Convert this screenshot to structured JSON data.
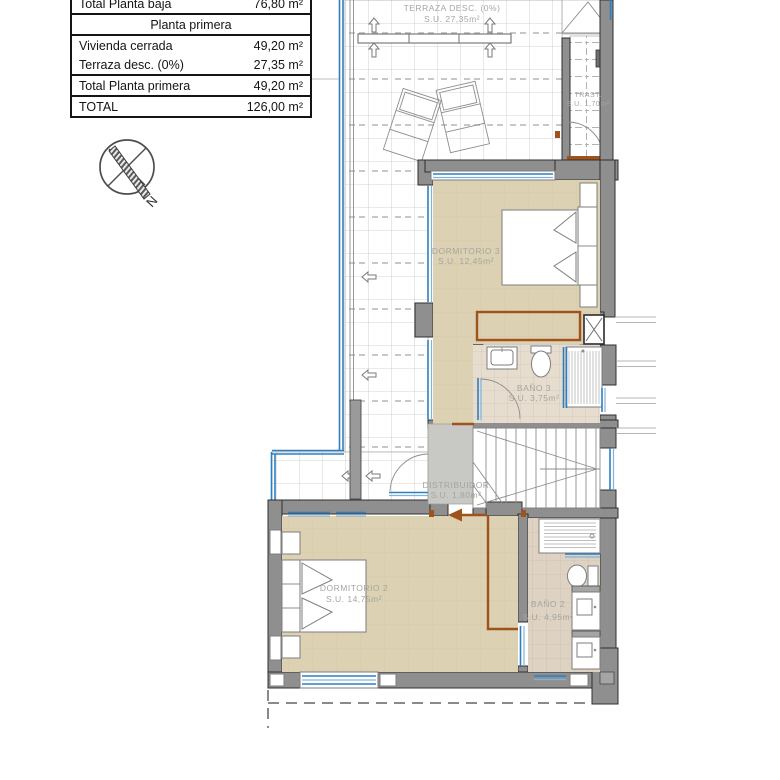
{
  "area_table": {
    "rows": [
      {
        "label": "Total Planta baja",
        "value": "76,80 m²"
      },
      {
        "label": "Planta primera",
        "value": ""
      },
      {
        "label": "Vivienda cerrada",
        "value": "49,20 m²"
      },
      {
        "label": "Terraza desc. (0%)",
        "value": "27,35 m²"
      },
      {
        "label": "Total Planta primera",
        "value": "49,20 m²"
      },
      {
        "label": "TOTAL",
        "value": "126,00 m²"
      }
    ]
  },
  "compass": {
    "north_label": "N"
  },
  "plan": {
    "rooms": [
      {
        "name": "TERRAZA DESC. (0%)",
        "area": "S.U. 27,35m²"
      },
      {
        "name": "TRAST.",
        "area": "S.U. 1,70m²"
      },
      {
        "name": "DORMITORIO 3",
        "area": "S.U. 12,45m²"
      },
      {
        "name": "BAÑO 3",
        "area": "S.U. 3,75m²"
      },
      {
        "name": "DISTRIBUIDOR",
        "area": "S.U. 1,80m²"
      },
      {
        "name": "DORMITORIO 2",
        "area": "S.U. 14,75m²"
      },
      {
        "name": "BAÑO 2",
        "area": "S.U. 4,95m²"
      }
    ],
    "colors": {
      "wall": "#8f8f8f",
      "floor_bedroom": "#dcd1b2",
      "floor_bath": "#e7ddcf",
      "floor_hall": "#c8c8c4",
      "window_glass": "#2e7fc0",
      "annotation_brown": "#a0521c",
      "label_text": "#a5a5a0"
    }
  }
}
